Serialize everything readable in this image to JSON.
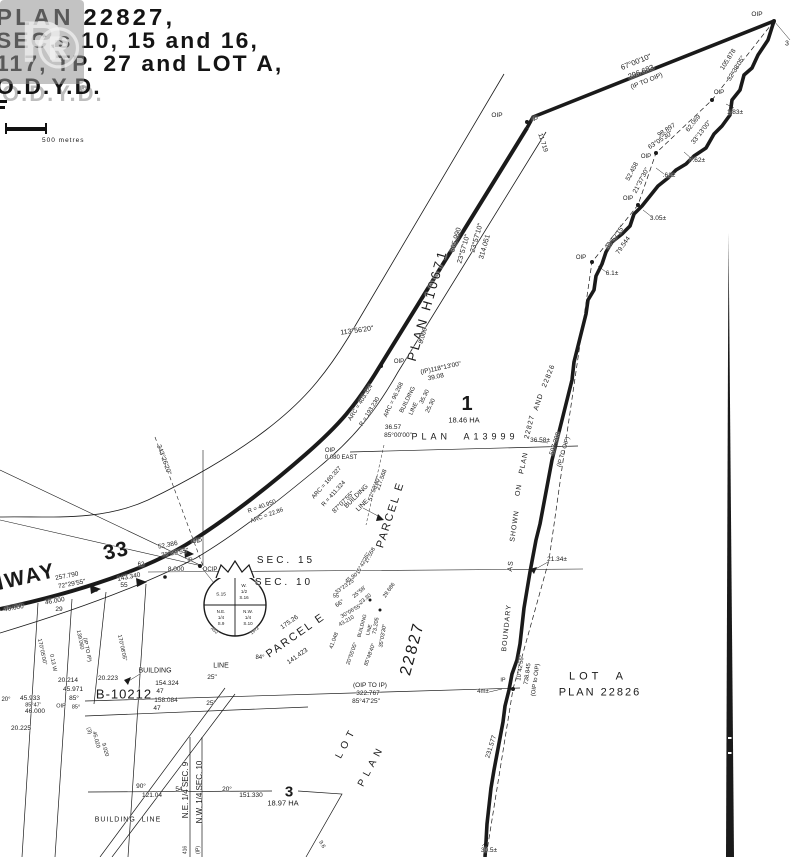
{
  "title_block": {
    "line1": "PLAN 22827,",
    "line2": "SEC.s 10, 15 and 16,",
    "line3": "117, TP. 27 and LOT A,",
    "line4": "O.D.Y.D.",
    "registered_mark": "®"
  },
  "watermark": {
    "letter": "R",
    "registered_mark": "®"
  },
  "scale_bar": {
    "label": "500 metres"
  },
  "colors": {
    "ink": "#1a1a1a",
    "paper": "#ffffff",
    "watermark_gray": "#919191"
  },
  "labels": [
    {
      "t": "OIP",
      "x": 757,
      "y": 15,
      "s": 6.5
    },
    {
      "t": "3",
      "x": 787,
      "y": 44,
      "s": 7
    },
    {
      "t": "67°00'10\"",
      "x": 636,
      "y": 62,
      "r": -22,
      "s": 7.5
    },
    {
      "t": "296.683",
      "x": 641,
      "y": 72,
      "r": -22,
      "s": 7.5
    },
    {
      "t": "(IP TO OIP)",
      "x": 647,
      "y": 82,
      "r": -22,
      "s": 6.5
    },
    {
      "t": "OIP",
      "x": 497,
      "y": 116,
      "s": 6.5
    },
    {
      "t": "IP",
      "x": 535,
      "y": 120,
      "s": 6
    },
    {
      "t": "11.719",
      "x": 542,
      "y": 143,
      "r": 72,
      "s": 6.5
    },
    {
      "t": "105.878",
      "x": 729,
      "y": 60,
      "r": -58,
      "s": 6.5
    },
    {
      "t": "32°38'05\"",
      "x": 737,
      "y": 69,
      "r": -58,
      "s": 6.5
    },
    {
      "t": "OIP",
      "x": 719,
      "y": 93,
      "s": 6
    },
    {
      "t": "1.83±",
      "x": 735,
      "y": 113,
      "s": 6.5
    },
    {
      "t": "62.069",
      "x": 694,
      "y": 124,
      "r": -52,
      "s": 6.5
    },
    {
      "t": "33°13'00\"",
      "x": 702,
      "y": 133,
      "r": -52,
      "s": 6.5
    },
    {
      "t": "98.897",
      "x": 667,
      "y": 131,
      "r": -33,
      "s": 6.5
    },
    {
      "t": "63°05'30\"",
      "x": 661,
      "y": 141,
      "r": -33,
      "s": 6.5
    },
    {
      "t": "OIP",
      "x": 646,
      "y": 157,
      "s": 6
    },
    {
      "t": "7.62±",
      "x": 697,
      "y": 161,
      "s": 6.5
    },
    {
      "t": "52.458",
      "x": 633,
      "y": 172,
      "r": -62,
      "s": 6.5
    },
    {
      "t": "21°37'30\"",
      "x": 642,
      "y": 181,
      "r": -62,
      "s": 6.5
    },
    {
      "t": ".61±",
      "x": 669,
      "y": 176,
      "s": 6.5
    },
    {
      "t": "OIP",
      "x": 628,
      "y": 199,
      "s": 6
    },
    {
      "t": "3.05±",
      "x": 658,
      "y": 219,
      "s": 6.5
    },
    {
      "t": "32°57'15\"",
      "x": 616,
      "y": 238,
      "r": -55,
      "s": 6.5
    },
    {
      "t": "79.544",
      "x": 624,
      "y": 246,
      "r": -55,
      "s": 6.5
    },
    {
      "t": "OIP",
      "x": 581,
      "y": 258,
      "s": 6
    },
    {
      "t": "6.1±",
      "x": 612,
      "y": 274,
      "s": 6.5
    },
    {
      "n": "road-name",
      "t": "PLAN H10671",
      "x": 427,
      "y": 305,
      "r": -74,
      "s": 13,
      "sp": 3
    },
    {
      "t": "305.990",
      "x": 456,
      "y": 240,
      "r": -74,
      "s": 7
    },
    {
      "t": "23°57'10\"",
      "x": 464,
      "y": 249,
      "r": -74,
      "s": 7
    },
    {
      "t": "23°57'10\"",
      "x": 477,
      "y": 238,
      "r": -74,
      "s": 7
    },
    {
      "t": "314.051",
      "x": 485,
      "y": 247,
      "r": -74,
      "s": 7
    },
    {
      "t": "113°56'20\"",
      "x": 357,
      "y": 331,
      "r": -8,
      "s": 7
    },
    {
      "t": "8.000",
      "x": 424,
      "y": 336,
      "r": -74,
      "s": 6.5
    },
    {
      "t": "(IP)118°13'00\"",
      "x": 441,
      "y": 369,
      "r": -12,
      "s": 6.5
    },
    {
      "t": "39.08",
      "x": 436,
      "y": 378,
      "r": -12,
      "s": 6.5
    },
    {
      "t": "OIP",
      "x": 399,
      "y": 362,
      "s": 6
    },
    {
      "t": "ARC = 96.268",
      "x": 394,
      "y": 400,
      "r": -64,
      "s": 6
    },
    {
      "t": "BUILDING",
      "x": 408,
      "y": 400,
      "r": -64,
      "s": 6
    },
    {
      "t": "LINE",
      "x": 414,
      "y": 409,
      "r": -64,
      "s": 6
    },
    {
      "t": "35.30",
      "x": 425,
      "y": 397,
      "r": -64,
      "s": 6
    },
    {
      "t": "25.30",
      "x": 431,
      "y": 406,
      "r": -64,
      "s": 6
    },
    {
      "t": "ARC = 403.324",
      "x": 361,
      "y": 403,
      "r": -58,
      "s": 6
    },
    {
      "t": "R = 193.230",
      "x": 370,
      "y": 412,
      "r": -58,
      "s": 6
    },
    {
      "t": "ARC = 160.327",
      "x": 327,
      "y": 483,
      "r": -48,
      "s": 6
    },
    {
      "t": "R = 411.324",
      "x": 334,
      "y": 494,
      "r": -48,
      "s": 6
    },
    {
      "t": "36.57",
      "x": 393,
      "y": 428,
      "s": 6.5
    },
    {
      "t": "85°00'00\"",
      "x": 398,
      "y": 436,
      "s": 6.5
    },
    {
      "n": "plan-a13999",
      "t": "PLAN  A13999",
      "x": 465,
      "y": 437,
      "s": 9,
      "sp": 4
    },
    {
      "n": "lot-1",
      "t": "1",
      "x": 467,
      "y": 404,
      "s": 20,
      "b": 1
    },
    {
      "n": "lot-1-area",
      "t": "18.46 HA",
      "x": 464,
      "y": 420,
      "s": 7.5
    },
    {
      "t": "OIP",
      "x": 330,
      "y": 451,
      "s": 6
    },
    {
      "t": "0.080 EAST",
      "x": 341,
      "y": 458,
      "s": 6
    },
    {
      "t": "87°07'55\"",
      "x": 344,
      "y": 503,
      "r": -45,
      "s": 6.5
    },
    {
      "t": "BUILDING",
      "x": 357,
      "y": 497,
      "r": -45,
      "s": 6.5
    },
    {
      "t": "LINE",
      "x": 363,
      "y": 506,
      "r": -45,
      "s": 6.5
    },
    {
      "t": "217.568",
      "x": 382,
      "y": 480,
      "r": -70,
      "s": 6
    },
    {
      "t": "57°58'40\"",
      "x": 375,
      "y": 489,
      "r": -70,
      "s": 6
    },
    {
      "n": "parcel-e",
      "t": "PARCEL E",
      "x": 391,
      "y": 515,
      "r": -72,
      "s": 11,
      "sp": 2
    },
    {
      "n": "parcel-e-2",
      "t": "PARCEL E",
      "x": 296,
      "y": 636,
      "r": -35,
      "s": 11,
      "sp": 2
    },
    {
      "t": "175.26",
      "x": 290,
      "y": 623,
      "r": -35,
      "s": 6.5
    },
    {
      "t": "141.423",
      "x": 298,
      "y": 657,
      "r": -35,
      "s": 6.5
    },
    {
      "t": "66°",
      "x": 340,
      "y": 604,
      "r": -35,
      "s": 6
    },
    {
      "t": "84°",
      "x": 260,
      "y": 658,
      "s": 6
    },
    {
      "n": "plan-22827-label",
      "t": "22827",
      "x": 413,
      "y": 649,
      "r": -75,
      "s": 16,
      "sp": 2
    },
    {
      "n": "sec-15",
      "t": "SEC. 15",
      "x": 286,
      "y": 561,
      "s": 10,
      "sp": 3
    },
    {
      "n": "sec-10",
      "t": "SEC. 10",
      "x": 284,
      "y": 583,
      "s": 10,
      "sp": 3
    },
    {
      "t": "S.15",
      "x": 221,
      "y": 596,
      "s": 4.8
    },
    {
      "t": "W.",
      "x": 244,
      "y": 586,
      "s": 4.5
    },
    {
      "t": "1/2",
      "x": 244,
      "y": 592,
      "s": 4.5
    },
    {
      "t": "S.16",
      "x": 244,
      "y": 598,
      "s": 4.5
    },
    {
      "t": "N.E.",
      "x": 221,
      "y": 612,
      "s": 4.5
    },
    {
      "t": "1/4",
      "x": 221,
      "y": 618,
      "s": 4.5
    },
    {
      "t": "S.9",
      "x": 221,
      "y": 624,
      "s": 4.5
    },
    {
      "t": "N.W.",
      "x": 248,
      "y": 612,
      "s": 4.5
    },
    {
      "t": "1/4",
      "x": 248,
      "y": 618,
      "s": 4.5
    },
    {
      "t": "S.10",
      "x": 248,
      "y": 624,
      "s": 4.5
    },
    {
      "t": "A52",
      "x": 214,
      "y": 631,
      "r": 40,
      "s": 4.5
    },
    {
      "t": "1972",
      "x": 255,
      "y": 631,
      "r": -40,
      "s": 4.5
    },
    {
      "n": "highway-name",
      "t": "HWAY",
      "x": 22,
      "y": 578,
      "r": -13,
      "s": 21,
      "sp": 2,
      "b": 1
    },
    {
      "n": "highway-number",
      "t": "33",
      "x": 116,
      "y": 551,
      "r": -13,
      "s": 21,
      "sp": 1,
      "b": 1
    },
    {
      "t": "257.790",
      "x": 67,
      "y": 577,
      "r": -11,
      "s": 6.5
    },
    {
      "t": "72°29'55\"",
      "x": 72,
      "y": 585,
      "r": -11,
      "s": 6.5
    },
    {
      "t": "52.386",
      "x": 168,
      "y": 546,
      "r": -11,
      "s": 6.5
    },
    {
      "t": "72°29'55\"",
      "x": 175,
      "y": 554,
      "r": -11,
      "s": 6.5
    },
    {
      "t": "OIP",
      "x": 197,
      "y": 542,
      "s": 6
    },
    {
      "t": "IP",
      "x": 190,
      "y": 561,
      "s": 5.5
    },
    {
      "t": "62",
      "x": 141,
      "y": 565,
      "s": 6
    },
    {
      "t": "8.000",
      "x": 176,
      "y": 570,
      "s": 6.5
    },
    {
      "t": "OCIP",
      "x": 210,
      "y": 570,
      "s": 6
    },
    {
      "t": "143.340",
      "x": 129,
      "y": 578,
      "r": -11,
      "s": 6.5
    },
    {
      "t": "55",
      "x": 124,
      "y": 586,
      "s": 6.5
    },
    {
      "t": "46.000",
      "x": 55,
      "y": 602,
      "r": -10,
      "s": 6.5
    },
    {
      "t": "29",
      "x": 59,
      "y": 610,
      "s": 6.5
    },
    {
      "t": "46.000",
      "x": 14,
      "y": 609,
      "r": -10,
      "s": 6.5
    },
    {
      "t": "343°26'20\"",
      "x": 163,
      "y": 460,
      "r": 70,
      "s": 6.5
    },
    {
      "t": "R = 40.950",
      "x": 262,
      "y": 507,
      "r": -20,
      "s": 6
    },
    {
      "t": "ARC = 22.86",
      "x": 267,
      "y": 516,
      "r": -20,
      "s": 6
    },
    {
      "t": "17.558",
      "x": 371,
      "y": 556,
      "r": -62,
      "s": 5.5
    },
    {
      "t": "15°42'25\"",
      "x": 364,
      "y": 564,
      "r": -62,
      "s": 5.5
    },
    {
      "t": "45.90",
      "x": 352,
      "y": 579,
      "r": -35,
      "s": 5.5
    },
    {
      "t": "33°23'25\"",
      "x": 346,
      "y": 587,
      "r": -35,
      "s": 5.5
    },
    {
      "t": "55",
      "x": 336,
      "y": 597,
      "s": 5.5
    },
    {
      "t": "25°58'",
      "x": 360,
      "y": 593,
      "r": -40,
      "s": 5.5
    },
    {
      "t": "23.30",
      "x": 366,
      "y": 600,
      "r": -40,
      "s": 5.5
    },
    {
      "t": "29.686",
      "x": 390,
      "y": 591,
      "r": -55,
      "s": 5.5
    },
    {
      "t": "30°06'55\"",
      "x": 352,
      "y": 612,
      "r": -30,
      "s": 5.5
    },
    {
      "t": "43.210",
      "x": 347,
      "y": 622,
      "r": -30,
      "s": 5.5
    },
    {
      "t": "41.048",
      "x": 335,
      "y": 641,
      "r": -70,
      "s": 5.5
    },
    {
      "t": "BUILDING",
      "x": 363,
      "y": 626,
      "r": -75,
      "s": 5
    },
    {
      "t": "LINE",
      "x": 370,
      "y": 630,
      "r": -75,
      "s": 5
    },
    {
      "t": "73.205",
      "x": 377,
      "y": 626,
      "r": -80,
      "s": 5.5
    },
    {
      "t": "35°03'30\"",
      "x": 384,
      "y": 636,
      "r": -80,
      "s": 5.5
    },
    {
      "t": "20°55'05\"",
      "x": 353,
      "y": 654,
      "r": -70,
      "s": 5.5
    },
    {
      "t": "85°48'40\"",
      "x": 371,
      "y": 655,
      "r": -70,
      "s": 5.5
    },
    {
      "t": "20.214",
      "x": 68,
      "y": 681,
      "s": 6.5
    },
    {
      "t": "45.971",
      "x": 73,
      "y": 690,
      "s": 6.5
    },
    {
      "t": "85°",
      "x": 74,
      "y": 699,
      "s": 6.5
    },
    {
      "t": "20.223",
      "x": 108,
      "y": 679,
      "s": 6.5
    },
    {
      "n": "plan-b10212",
      "t": "B-10212",
      "x": 124,
      "y": 694,
      "s": 13,
      "sp": 1
    },
    {
      "t": "BUILDING",
      "x": 155,
      "y": 671,
      "s": 7
    },
    {
      "t": "LINE",
      "x": 221,
      "y": 666,
      "s": 7
    },
    {
      "t": "154.324",
      "x": 167,
      "y": 684,
      "s": 6.5
    },
    {
      "t": "47",
      "x": 160,
      "y": 692,
      "s": 6.5
    },
    {
      "t": "25\"",
      "x": 212,
      "y": 678,
      "s": 6.5
    },
    {
      "t": "158.084",
      "x": 166,
      "y": 701,
      "s": 6.5
    },
    {
      "t": "47",
      "x": 157,
      "y": 709,
      "s": 6.5
    },
    {
      "t": "25\"",
      "x": 211,
      "y": 704,
      "s": 6.5
    },
    {
      "t": "45.933",
      "x": 30,
      "y": 699,
      "s": 6.5
    },
    {
      "t": "85°47'",
      "x": 33,
      "y": 706,
      "s": 5.5
    },
    {
      "t": "46.000",
      "x": 35,
      "y": 712,
      "s": 6.5
    },
    {
      "t": "20°",
      "x": 6,
      "y": 700,
      "s": 6
    },
    {
      "t": "20.225",
      "x": 21,
      "y": 729,
      "s": 6.5
    },
    {
      "t": "OIP",
      "x": 61,
      "y": 707,
      "s": 5.5
    },
    {
      "t": "85°",
      "x": 76,
      "y": 708,
      "s": 5.5
    },
    {
      "t": "170°05'00\"",
      "x": 41,
      "y": 652,
      "r": 78,
      "s": 5.5
    },
    {
      "t": "0.13 W",
      "x": 52,
      "y": 663,
      "r": 78,
      "s": 5.5
    },
    {
      "t": "139.060",
      "x": 79,
      "y": 640,
      "r": 78,
      "s": 5.5
    },
    {
      "t": "(IP TO IP)",
      "x": 86,
      "y": 650,
      "r": 78,
      "s": 5.5
    },
    {
      "t": "170°08'05\"",
      "x": 121,
      "y": 648,
      "r": 78,
      "s": 5.5
    },
    {
      "t": "45.020",
      "x": 95,
      "y": 740,
      "r": 75,
      "s": 5.5
    },
    {
      "t": "(3)",
      "x": 88,
      "y": 731,
      "r": 75,
      "s": 5.5
    },
    {
      "t": "9.020",
      "x": 104,
      "y": 750,
      "r": 75,
      "s": 5.5
    },
    {
      "t": "(OIP TO IP)",
      "x": 370,
      "y": 686,
      "s": 6.5
    },
    {
      "t": "322.767",
      "x": 368,
      "y": 694,
      "s": 6.5
    },
    {
      "t": "85°47'25\"",
      "x": 366,
      "y": 702,
      "s": 6.5
    },
    {
      "t": "36.58±",
      "x": 540,
      "y": 441,
      "s": 6.5
    },
    {
      "t": "507.208",
      "x": 556,
      "y": 444,
      "r": -73,
      "s": 6.5
    },
    {
      "t": "(IP TO OIP)",
      "x": 564,
      "y": 452,
      "r": -73,
      "s": 6
    },
    {
      "n": "boundary-note",
      "t": "BOUNDARY",
      "x": 507,
      "y": 628,
      "r": -84,
      "s": 7,
      "sp": 1
    },
    {
      "n": "boundary-note",
      "t": "AS",
      "x": 511,
      "y": 566,
      "r": -84,
      "s": 7,
      "sp": 1
    },
    {
      "n": "boundary-note",
      "t": "SHOWN",
      "x": 515,
      "y": 526,
      "r": -82,
      "s": 7,
      "sp": 1
    },
    {
      "n": "boundary-note",
      "t": "ON",
      "x": 519,
      "y": 490,
      "r": -80,
      "s": 7,
      "sp": 1
    },
    {
      "n": "boundary-note",
      "t": "PLAN",
      "x": 524,
      "y": 463,
      "r": -78,
      "s": 7,
      "sp": 1
    },
    {
      "n": "boundary-note",
      "t": "22827",
      "x": 530,
      "y": 427,
      "r": -76,
      "s": 7,
      "sp": 1
    },
    {
      "n": "boundary-note",
      "t": "AND",
      "x": 539,
      "y": 402,
      "r": -72,
      "s": 7,
      "sp": 1
    },
    {
      "n": "boundary-note",
      "t": "22826",
      "x": 549,
      "y": 376,
      "r": -68,
      "s": 7,
      "sp": 1
    },
    {
      "t": "21.34±",
      "x": 557,
      "y": 560,
      "s": 6.5
    },
    {
      "t": "10°42'56\"",
      "x": 521,
      "y": 668,
      "r": -82,
      "s": 6
    },
    {
      "t": "738.845",
      "x": 528,
      "y": 674,
      "r": -82,
      "s": 6
    },
    {
      "t": "(OIP to OIP)",
      "x": 536,
      "y": 680,
      "r": -82,
      "s": 6
    },
    {
      "t": "IP",
      "x": 503,
      "y": 681,
      "s": 5.5
    },
    {
      "t": "4m±",
      "x": 483,
      "y": 692,
      "s": 6
    },
    {
      "n": "lot-a",
      "t": "LOT  A",
      "x": 598,
      "y": 677,
      "s": 11,
      "sp": 4
    },
    {
      "n": "lot-a-plan",
      "t": "PLAN 22826",
      "x": 600,
      "y": 693,
      "s": 11,
      "sp": 2
    },
    {
      "t": "231.577",
      "x": 492,
      "y": 747,
      "r": -73,
      "s": 6.5
    },
    {
      "t": "30.5±",
      "x": 489,
      "y": 851,
      "s": 6.5
    },
    {
      "n": "sec9-quarter",
      "t": "N.E. 1/4 SEC. 9",
      "x": 186,
      "y": 790,
      "r": -90,
      "s": 8
    },
    {
      "n": "sec10-quarter",
      "t": "N.W. 1/4 SEC. 10",
      "x": 200,
      "y": 792,
      "r": -90,
      "s": 8
    },
    {
      "t": "416",
      "x": 186,
      "y": 850,
      "r": -90,
      "s": 5
    },
    {
      "t": "(IP)",
      "x": 199,
      "y": 850,
      "r": -90,
      "s": 5
    },
    {
      "t": "90°",
      "x": 141,
      "y": 787,
      "s": 6.5
    },
    {
      "t": "121.04",
      "x": 152,
      "y": 796,
      "s": 6.5
    },
    {
      "t": "54",
      "x": 179,
      "y": 790,
      "s": 6.5
    },
    {
      "t": "20°",
      "x": 227,
      "y": 790,
      "s": 6.5
    },
    {
      "t": "151.330",
      "x": 251,
      "y": 796,
      "s": 6.5
    },
    {
      "n": "lot-3",
      "t": "3",
      "x": 289,
      "y": 792,
      "s": 15,
      "b": 1
    },
    {
      "n": "lot-3-area",
      "t": "18.97 HA",
      "x": 283,
      "y": 803,
      "s": 7.5
    },
    {
      "n": "building-line-bottom",
      "t": "BUILDING  LINE",
      "x": 128,
      "y": 820,
      "s": 7,
      "sp": 1
    },
    {
      "n": "lot-word",
      "t": "LOT",
      "x": 347,
      "y": 743,
      "r": -62,
      "s": 10,
      "sp": 5
    },
    {
      "n": "plan-word",
      "t": "PLAN",
      "x": 372,
      "y": 766,
      "r": -62,
      "s": 10,
      "sp": 5
    },
    {
      "t": "9.6",
      "x": 321,
      "y": 845,
      "r": 60,
      "s": 5.5
    }
  ]
}
